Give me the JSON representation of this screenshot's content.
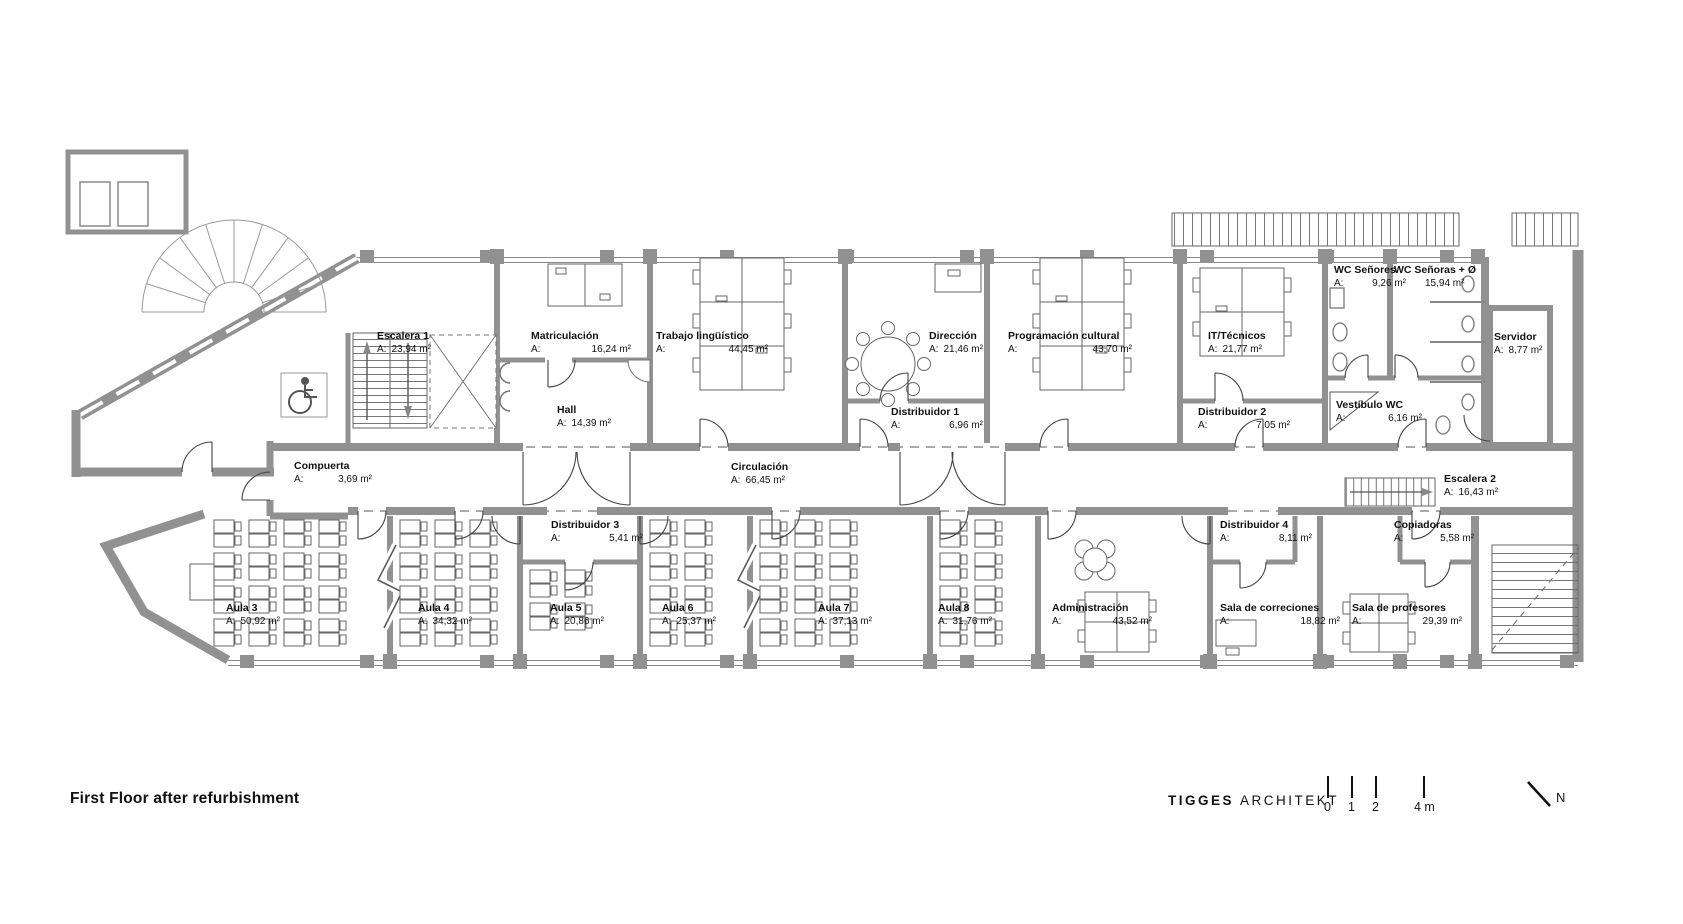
{
  "footer": {
    "title": "First Floor after refurbishment",
    "brand_primary": "TIGGES",
    "brand_secondary": "ARCHITEKT",
    "scale_labels": [
      "0",
      "1",
      "2",
      "4 m"
    ],
    "north_label": "N"
  },
  "colors": {
    "wall": "#919191",
    "line": "#555555",
    "text": "#111111"
  },
  "rooms": [
    {
      "name": "Escalera 1",
      "a": "A:",
      "value": "23,94 m²"
    },
    {
      "name": "Matriculación",
      "a": "A:",
      "value": "16,24 m²"
    },
    {
      "name": "Trabajo lingüístico",
      "a": "A:",
      "value": "44,45 m²"
    },
    {
      "name": "Dirección",
      "a": "A:",
      "value": "21,46 m²"
    },
    {
      "name": "Programación cultural",
      "a": "A:",
      "value": "43,70 m²"
    },
    {
      "name": "IT/Técnicos",
      "a": "A:",
      "value": "21,77 m²"
    },
    {
      "name": "WC Señores",
      "a": "A:",
      "value": "9,26 m²"
    },
    {
      "name": "WC Señoras + Ø",
      "a": "",
      "value": "15,94 m²"
    },
    {
      "name": "Servidor",
      "a": "A:",
      "value": "8,77 m²"
    },
    {
      "name": "Hall",
      "a": "A:",
      "value": "14,39 m²"
    },
    {
      "name": "Distribuidor 1",
      "a": "A:",
      "value": "6,96 m²"
    },
    {
      "name": "Distribuidor 2",
      "a": "A:",
      "value": "7,05 m²"
    },
    {
      "name": "Vestíbulo WC",
      "a": "A:",
      "value": "6,16 m²"
    },
    {
      "name": "Compuerta",
      "a": "A:",
      "value": "3,69 m²"
    },
    {
      "name": "Circulación",
      "a": "A:",
      "value": "66,45 m²"
    },
    {
      "name": "Escalera 2",
      "a": "A:",
      "value": "16,43 m²"
    },
    {
      "name": "Distribuidor 3",
      "a": "A:",
      "value": "5,41 m²"
    },
    {
      "name": "Distribuidor 4",
      "a": "A:",
      "value": "8,11 m²"
    },
    {
      "name": "Copiadoras",
      "a": "A:",
      "value": "5,58 m²"
    },
    {
      "name": "Aula 3",
      "a": "A:",
      "value": "50,92 m²"
    },
    {
      "name": "Aula 4",
      "a": "A:",
      "value": "34,32 m²"
    },
    {
      "name": "Aula 5",
      "a": "A:",
      "value": "20,86 m²"
    },
    {
      "name": "Aula 6",
      "a": "A:",
      "value": "25,37 m²"
    },
    {
      "name": "Aula 7",
      "a": "A:",
      "value": "37,13 m²"
    },
    {
      "name": "Aula 8",
      "a": "A:",
      "value": "31,76 m²"
    },
    {
      "name": "Administración",
      "a": "A:",
      "value": "43,52 m²"
    },
    {
      "name": "Sala de correciones",
      "a": "A:",
      "value": "18,82 m²"
    },
    {
      "name": "Sala de profesores",
      "a": "A:",
      "value": "29,39 m²"
    }
  ]
}
